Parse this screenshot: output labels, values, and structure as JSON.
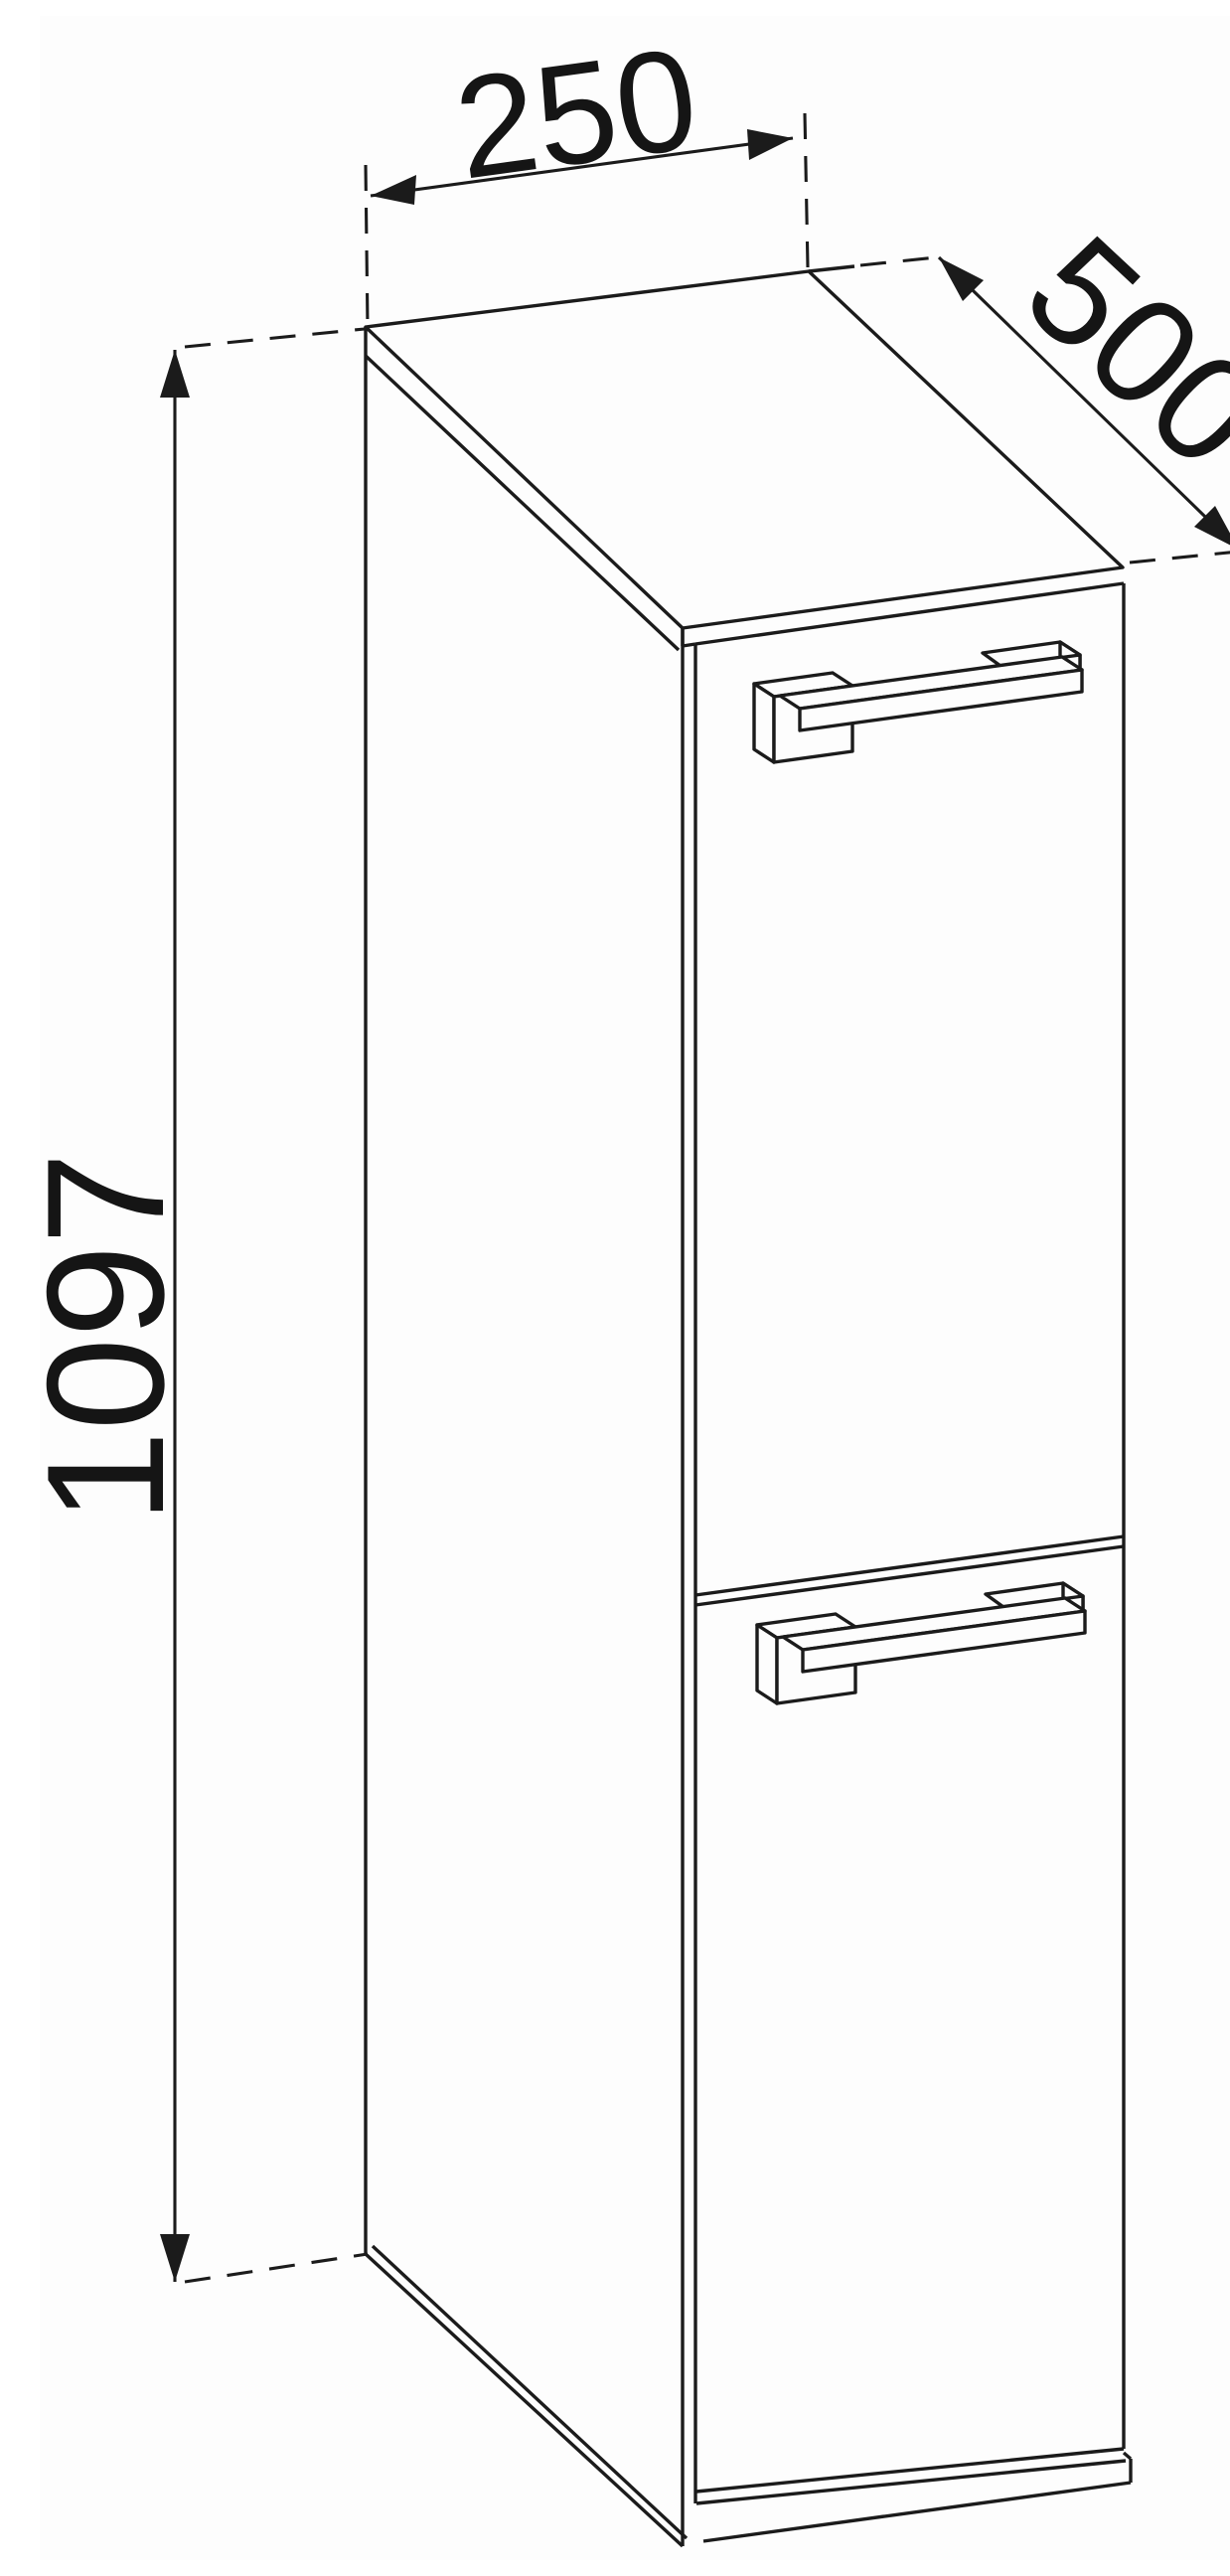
{
  "drawing": {
    "title": "Tall narrow cabinet - dimensioned technical drawing",
    "type": "furniture line drawing, axonometric projection",
    "dimensions": {
      "width_label": "250",
      "depth_label": "500",
      "height_label": "1097"
    },
    "parts": {
      "doors": 2,
      "handles": 2,
      "plinth": 1
    },
    "colors": {
      "line": "#1b1b1b",
      "background": "#fdfdfd",
      "text": "#151515"
    }
  }
}
